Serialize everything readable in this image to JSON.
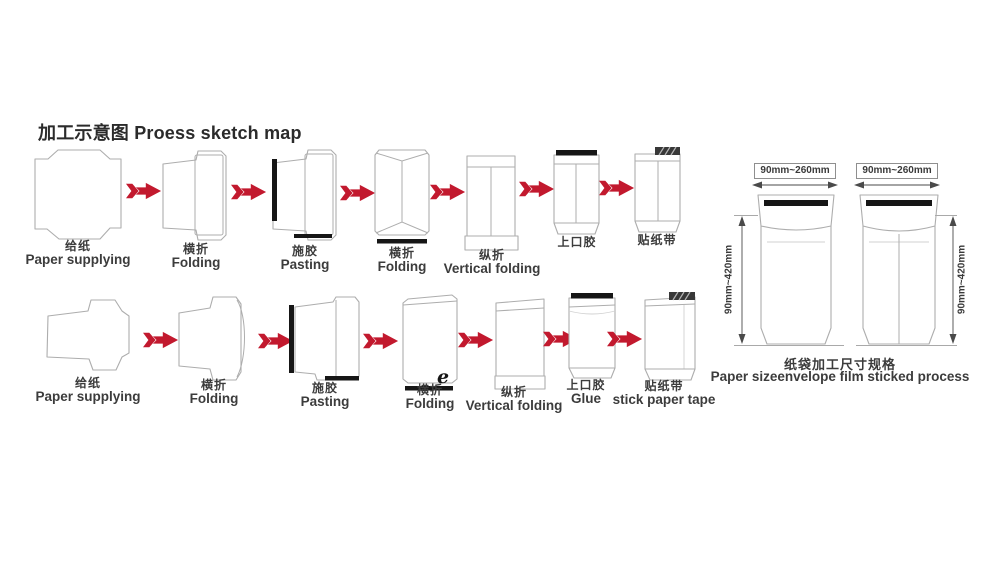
{
  "title": {
    "cn": "加工示意图",
    "en": "Proess sketch map"
  },
  "process_rows": [
    {
      "steps": [
        {
          "cn": "给纸",
          "en": "Paper supplying"
        },
        {
          "cn": "横折",
          "en": "Folding"
        },
        {
          "cn": "施胶",
          "en": "Pasting"
        },
        {
          "cn": "横折",
          "en": "Folding"
        },
        {
          "cn": "纵折",
          "en": "Vertical folding"
        },
        {
          "cn": "上口胶",
          "en": ""
        },
        {
          "cn": "贴纸带",
          "en": ""
        }
      ]
    },
    {
      "steps": [
        {
          "cn": "给纸",
          "en": "Paper supplying"
        },
        {
          "cn": "横折",
          "en": "Folding"
        },
        {
          "cn": "施胶",
          "en": "Pasting"
        },
        {
          "cn": "横折",
          "en": "Folding",
          "mark": "e"
        },
        {
          "cn": "纵折",
          "en": "Vertical folding"
        },
        {
          "cn": "上口胶",
          "en": "Glue"
        },
        {
          "cn": "贴纸带",
          "en": "stick paper tape"
        }
      ]
    }
  ],
  "size_panel": {
    "diagrams": [
      {
        "width_label": "90mm~260mm",
        "height_label": "90mm~420mm"
      },
      {
        "width_label": "90mm~260mm",
        "height_label": "90mm~420mm"
      }
    ],
    "caption_cn": "纸袋加工尺寸规格",
    "caption_en": "Paper sizeenvelope film sticked process"
  },
  "colors": {
    "red": "#c2192e",
    "outline": "#adadad",
    "bar": "#161616",
    "text": "#3c3c3c",
    "title": "#2b2b2b",
    "dim": "#4a4a4a"
  }
}
